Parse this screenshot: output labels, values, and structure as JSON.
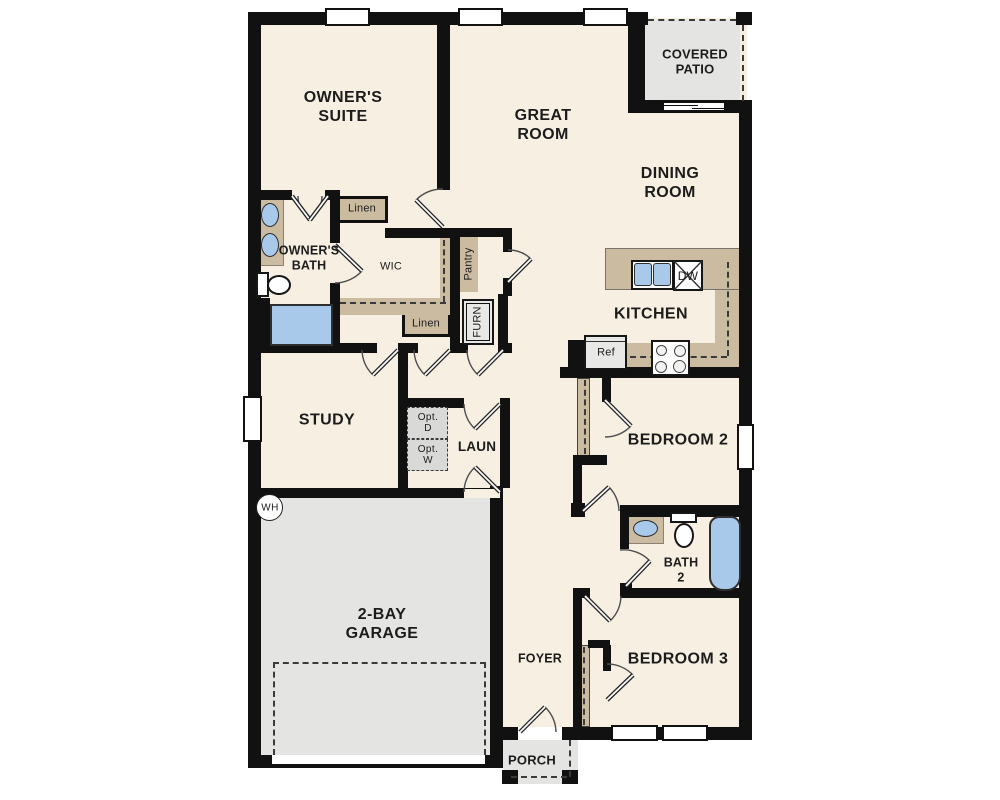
{
  "colors": {
    "wall": "#111111",
    "floor": "#f6efe2",
    "area_gray": "#e4e4e2",
    "cabinet_tan": "#cbbba0",
    "fixture_blue": "#a9c9ea",
    "text": "#1c1c1c"
  },
  "labels": {
    "owners_suite": "OWNER'S\nSUITE",
    "great_room": "GREAT\nROOM",
    "covered_patio": "COVERED\nPATIO",
    "dining_room": "DINING\nROOM",
    "owners_bath": "OWNER'S\nBATH",
    "wic": "WIC",
    "linen_upper": "Linen",
    "linen_lower": "Linen",
    "pantry": "Pantry",
    "furnace": "FURN",
    "kitchen": "KITCHEN",
    "dishwasher": "DW",
    "refrigerator": "Ref",
    "study": "STUDY",
    "laundry": "LAUN",
    "opt_dryer": "Opt.\nD",
    "opt_washer": "Opt.\nW",
    "water_heater": "WH",
    "bedroom2": "BEDROOM 2",
    "bath2": "BATH\n2",
    "bedroom3": "BEDROOM 3",
    "garage": "2-BAY\nGARAGE",
    "foyer": "FOYER",
    "porch": "PORCH"
  }
}
